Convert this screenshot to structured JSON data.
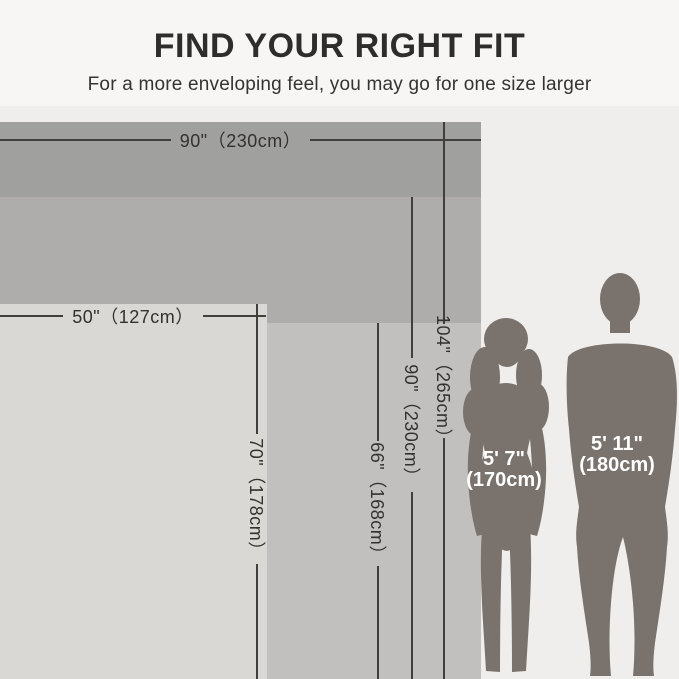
{
  "header": {
    "title": "FIND YOUR RIGHT FIT",
    "subtitle": "For a more enveloping feel, you may go for one size larger"
  },
  "size_chart": {
    "sizes": [
      {
        "width_in": 90,
        "width_cm": 230,
        "height_in": 104,
        "height_cm": 265
      },
      {
        "height_in": 90,
        "height_cm": 230
      },
      {
        "height_in": 66,
        "height_cm": 168
      },
      {
        "width_in": 50,
        "width_cm": 127,
        "height_in": 70,
        "height_cm": 178
      }
    ]
  },
  "dimension_labels": {
    "xl_width": "90\"（230cm）",
    "xl_height": "104\"（265cm）",
    "l_height": "90\"（230cm）",
    "m_height": "66\"（168cm）",
    "s_width": "50\"（127cm）",
    "s_height": "70\"（178cm）"
  },
  "people": {
    "woman": {
      "height_ft": "5' 7\"",
      "height_cm": "(170cm)"
    },
    "man": {
      "height_ft": "5' 11\"",
      "height_cm": "(180cm)"
    }
  },
  "colors": {
    "size_xl": "#a0a09e",
    "size_l": "#aeadac",
    "size_m": "#c1c0be",
    "size_s": "#d9d8d5",
    "background_top": "#f7f6f5",
    "background_main": "#efeeec",
    "line": "#413f3e",
    "silhouette": "#79726d",
    "person_label": "#ffffff"
  }
}
